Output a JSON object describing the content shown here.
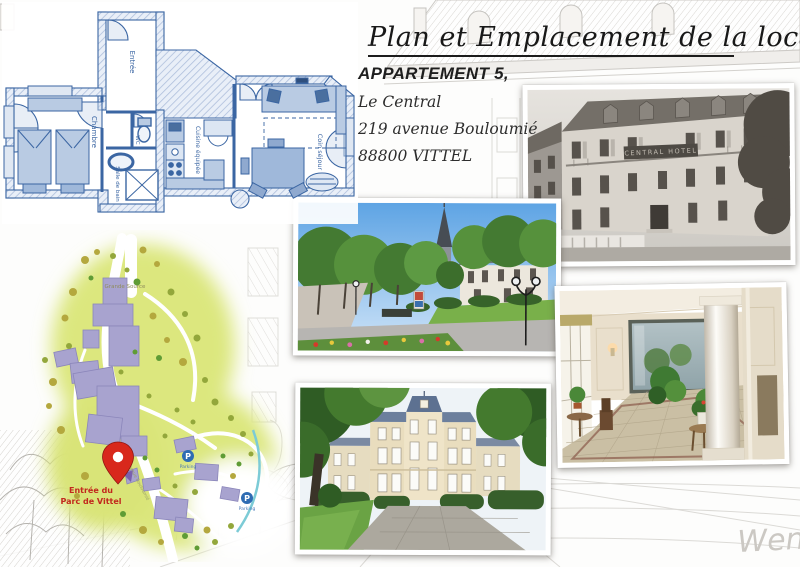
{
  "page": {
    "title": "Plan et Emplacement de la location",
    "signature": "Wen"
  },
  "address": {
    "line1": "APPARTEMENT 5,",
    "line2": "Le Central",
    "line3": "219 avenue Bouloumié",
    "line4": "88800 VITTEL"
  },
  "floor_plan": {
    "wall_color": "#3b66a3",
    "rooms": {
      "entree": "Entrée",
      "chambre": "Chambre",
      "salle_de_bain": "Salle de bain",
      "wc": "WC",
      "cuisine": "Cuisine équipée",
      "sejour": "Coin séjour"
    }
  },
  "park_map": {
    "ground_color": "#dce77e",
    "building_color": "#a8a3cf",
    "pin_color": "#d8281c",
    "entrance_label_line1": "Entrée du",
    "entrance_label_line2": "Parc de Vittel",
    "source_label": "Grande Source",
    "street_label": "avenue Bouloumié",
    "parking_letter": "P",
    "parking1_label": "Parking",
    "parking2_label": "Parking"
  },
  "photos": {
    "historic_sign": "CENTRAL HOTEL"
  }
}
